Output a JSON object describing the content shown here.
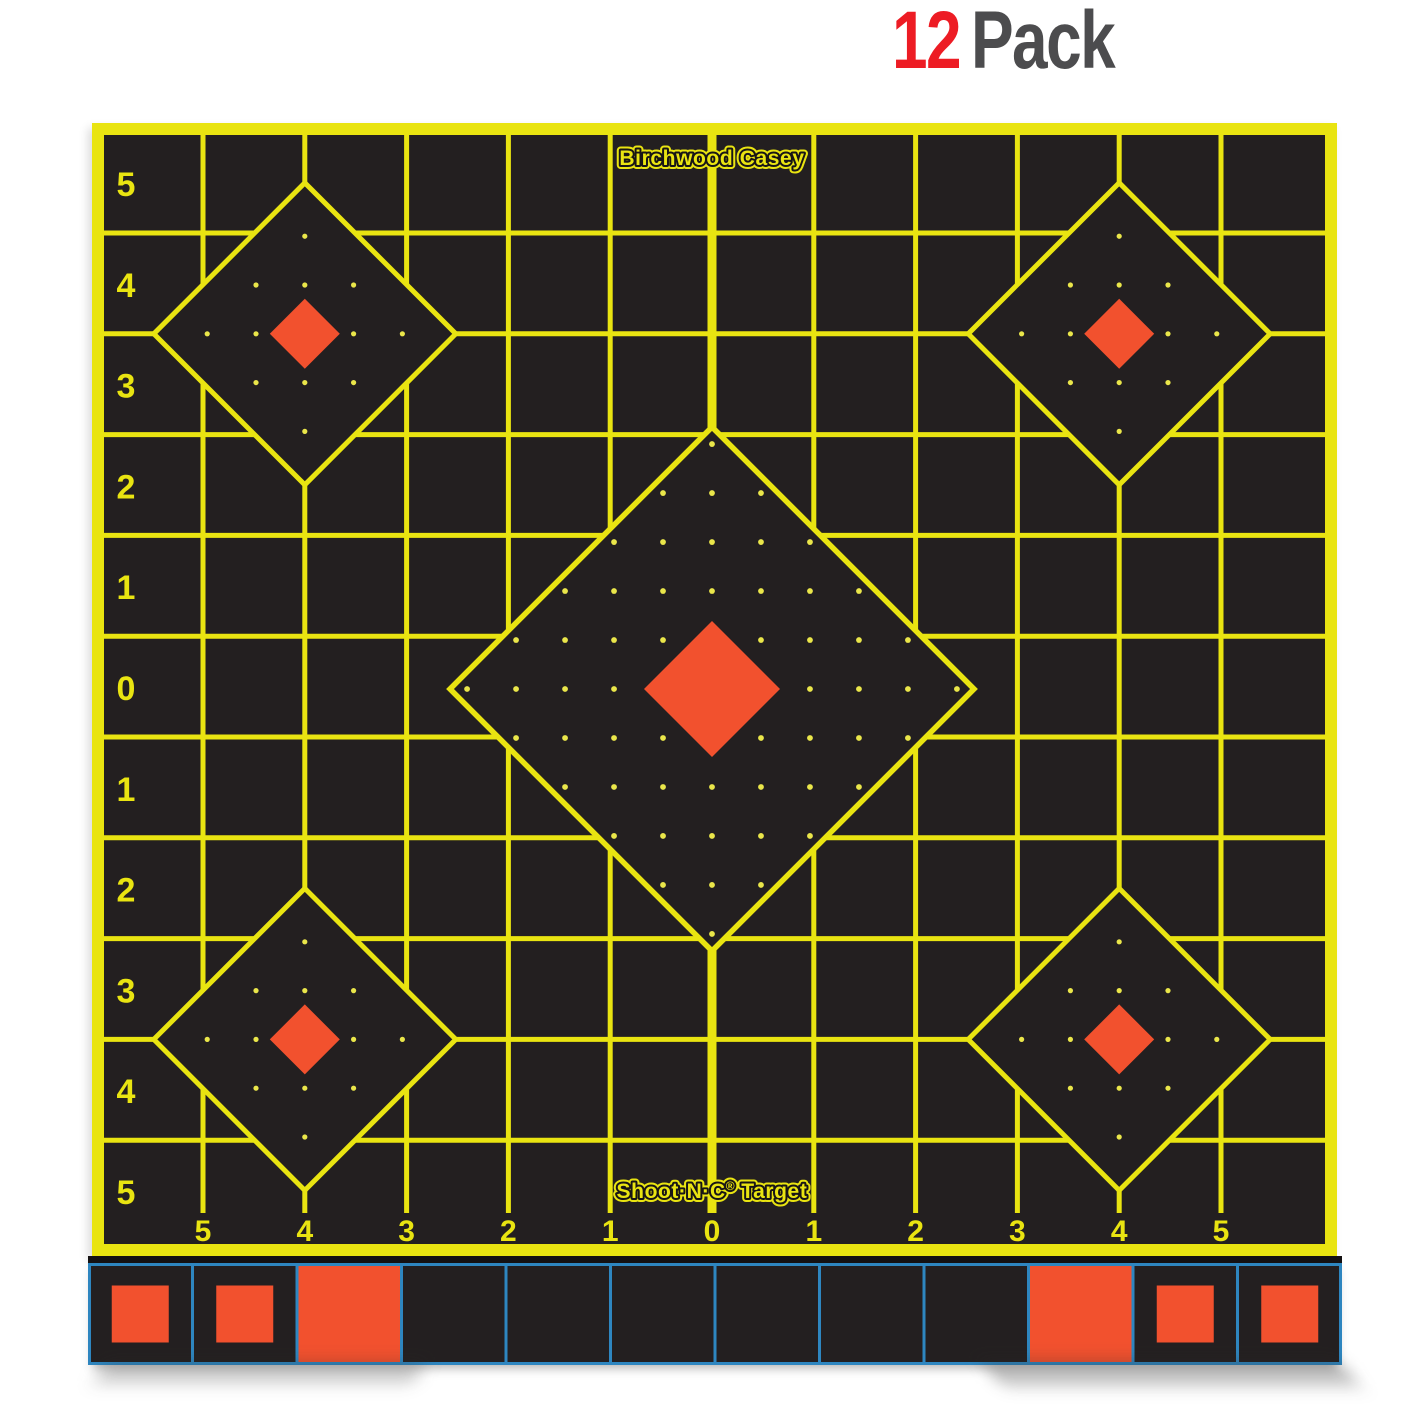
{
  "header": {
    "count": "12",
    "label": "Pack"
  },
  "colors": {
    "page_bg": "#ffffff",
    "yellow": "#e9e411",
    "black": "#231f20",
    "strip_top_band": "#141112",
    "orange": "#f2512e",
    "blue": "#2e86c0",
    "dot": "#eae64a",
    "red": "#ed1c24",
    "gray": "#4c4c4e"
  },
  "target": {
    "brand": "Birchwood Casey",
    "footer": {
      "product": "Shoot·N·C",
      "reg": "®",
      "suffix": "Target"
    },
    "left_axis": [
      "5",
      "4",
      "3",
      "2",
      "1",
      "0",
      "1",
      "2",
      "3",
      "4",
      "5"
    ],
    "bottom_axis": [
      "5",
      "4",
      "3",
      "2",
      "1",
      "0",
      "1",
      "2",
      "3",
      "4",
      "5"
    ]
  },
  "target_spec": {
    "sheet": {
      "x": 92,
      "y": 123,
      "w": 1245,
      "h": 1133,
      "border": 12
    },
    "grid": {
      "x0": 203,
      "dx": 101.8,
      "nv": 11,
      "y0": 233,
      "dy": 100.8,
      "nh": 10,
      "line_w": 5,
      "center_index": 5,
      "center_line_w": 9,
      "v_y1": 135,
      "v_y2": 1213,
      "h_x1": 104,
      "h_x2": 1325,
      "row_center0": 184,
      "left_label_x": 126,
      "bottom_label_y": 1241
    },
    "diamonds": [
      {
        "name": "center-sight",
        "cx": 712,
        "cy": 689,
        "half": 262,
        "orange_half": 68,
        "dot_unit": 50.5,
        "dot_max": 5,
        "dot_hide": 1,
        "dot_r": 2.9,
        "stroke_w": 5.5
      },
      {
        "name": "top-left-sight",
        "cx": 304.8,
        "cy": 333.8,
        "half": 151,
        "orange_half": 35,
        "dot_unit": 50.3,
        "dot_max": 2,
        "dot_hide": 0,
        "dot_r": 2.6,
        "stroke_w": 5
      },
      {
        "name": "top-right-sight",
        "cx": 1119.2,
        "cy": 333.8,
        "half": 151,
        "orange_half": 35,
        "dot_unit": 50.3,
        "dot_max": 2,
        "dot_hide": 0,
        "dot_r": 2.6,
        "stroke_w": 5
      },
      {
        "name": "bottom-left-sight",
        "cx": 304.8,
        "cy": 1039.4,
        "half": 151,
        "orange_half": 35,
        "dot_unit": 50.3,
        "dot_max": 2,
        "dot_hide": 0,
        "dot_r": 2.6,
        "stroke_w": 5
      },
      {
        "name": "bottom-right-sight",
        "cx": 1119.2,
        "cy": 1039.4,
        "half": 151,
        "orange_half": 35,
        "dot_unit": 50.3,
        "dot_max": 2,
        "dot_hide": 0,
        "dot_r": 2.6,
        "stroke_w": 5
      }
    ],
    "strip": {
      "x": 88,
      "y": 1256,
      "w": 1254,
      "top_band": 7,
      "cells_h": 102,
      "n": 12,
      "line_w": 3,
      "square": 57,
      "items": [
        "square",
        "square",
        "full",
        "empty",
        "empty",
        "empty",
        "empty",
        "empty",
        "empty",
        "full",
        "square",
        "square"
      ]
    }
  }
}
